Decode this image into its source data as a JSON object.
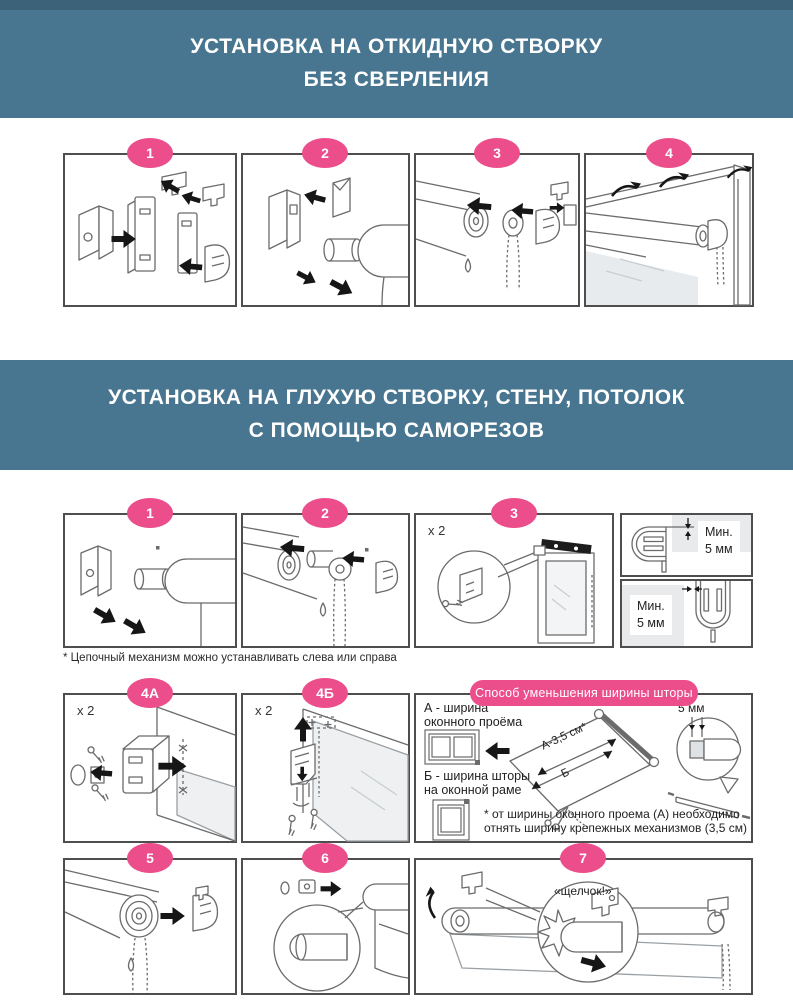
{
  "colors": {
    "banner_bg": "#48758f",
    "top_strip": "#3c627a",
    "badge_pink": "#ec4d8b",
    "box_border": "#4e4e4e",
    "glass_gray": "#e8ebed"
  },
  "section_no_drill": {
    "title_line1": "УСТАНОВКА НА ОТКИДНУЮ СТВОРКУ",
    "title_line2": "БЕЗ СВЕРЛЕНИЯ",
    "steps": [
      {
        "number": "1"
      },
      {
        "number": "2"
      },
      {
        "number": "3"
      },
      {
        "number": "4"
      }
    ]
  },
  "section_screws": {
    "title_line1": "УСТАНОВКА НА ГЛУХУЮ СТВОРКУ, СТЕНУ, ПОТОЛОК",
    "title_line2": "С ПОМОЩЬЮ САМОРЕЗОВ",
    "steps_row1": [
      {
        "number": "1"
      },
      {
        "number": "2"
      },
      {
        "number": "3",
        "qty": "x 2"
      }
    ],
    "min_top": {
      "line1": "Мин.",
      "line2": "5 мм"
    },
    "min_bottom": {
      "line1": "Мин.",
      "line2": "5 мм"
    },
    "footnote": "* Цепочный механизм можно устанавливать слева или справа",
    "steps_row2": [
      {
        "number": "4А",
        "qty": "x 2"
      },
      {
        "number": "4Б",
        "qty": "x 2"
      }
    ],
    "width_panel": {
      "title": "Способ уменьшения ширины шторы",
      "label_a_line1": "А - ширина",
      "label_a_line2": "оконного проёма",
      "label_b_line1": "Б - ширина шторы",
      "label_b_line2": "на оконной раме",
      "dim_a": "А-3,5 см*",
      "dim_b": "Б",
      "dim_5mm": "5 мм",
      "note_line1": "* от ширины оконного проема (А) необходимо",
      "note_line2": "отнять ширину крепежных механизмов (3,5 см)"
    },
    "steps_row3": [
      {
        "number": "5"
      },
      {
        "number": "6"
      },
      {
        "number": "7",
        "click_label": "«щелчок!»"
      }
    ]
  }
}
